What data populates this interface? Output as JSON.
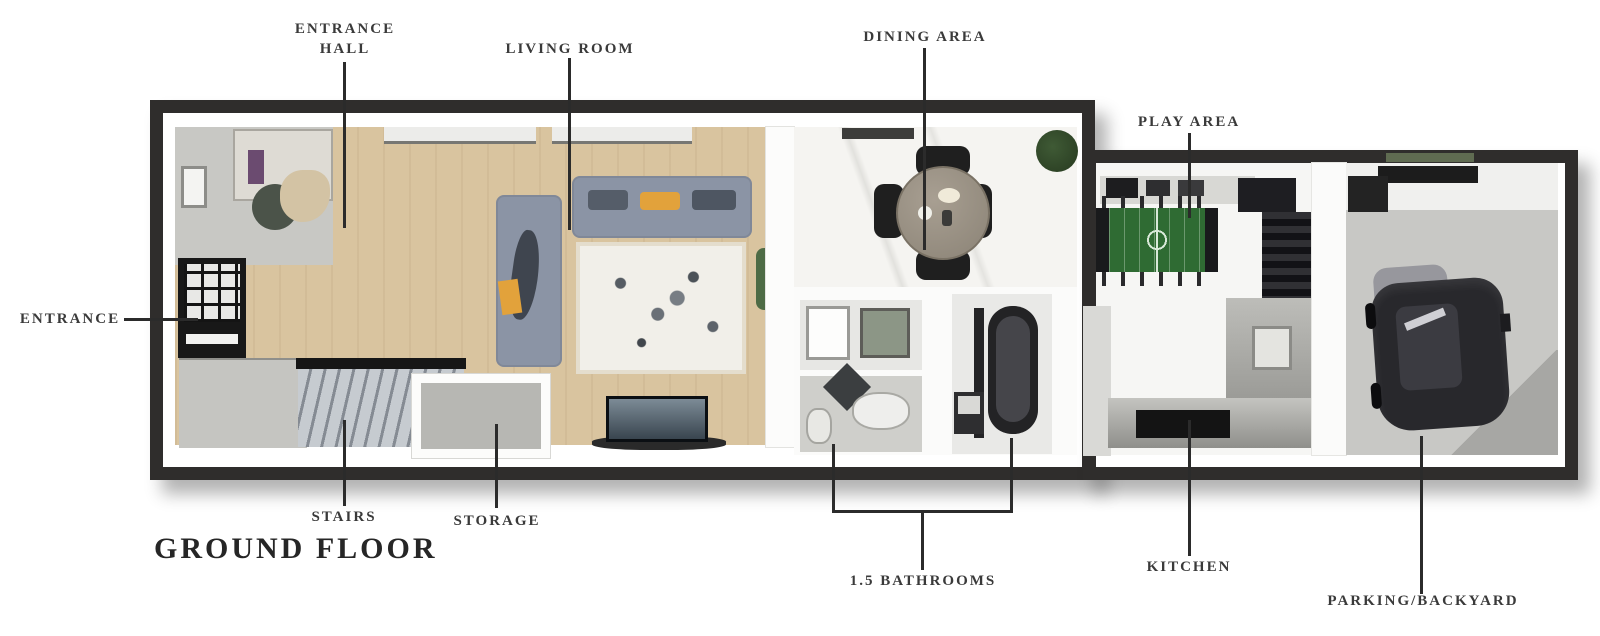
{
  "title": "GROUND FLOOR",
  "labels": {
    "entrance_hall": "ENTRANCE HALL",
    "living_room": "LIVING ROOM",
    "dining_area": "DINING AREA",
    "play_area": "PLAY AREA",
    "entrance": "ENTRANCE",
    "stairs": "STAIRS",
    "storage": "STORAGE",
    "bathrooms": "1.5 BATHROOMS",
    "kitchen": "KITCHEN",
    "parking_backyard": "PARKING/BACKYARD"
  },
  "colors": {
    "wall": "#2f2d2c",
    "label_text": "#3a3a3a",
    "wood_floor": "#d9c49f",
    "sofa": "#8b94a5",
    "accent_pillow": "#e2a23b",
    "foosball_green": "#2f6b33",
    "counter_gray": "#a8a8a5",
    "car_body": "#28282c",
    "stairs_gray": "#9aa0a8",
    "marble_floor": "#f5f4f1"
  }
}
